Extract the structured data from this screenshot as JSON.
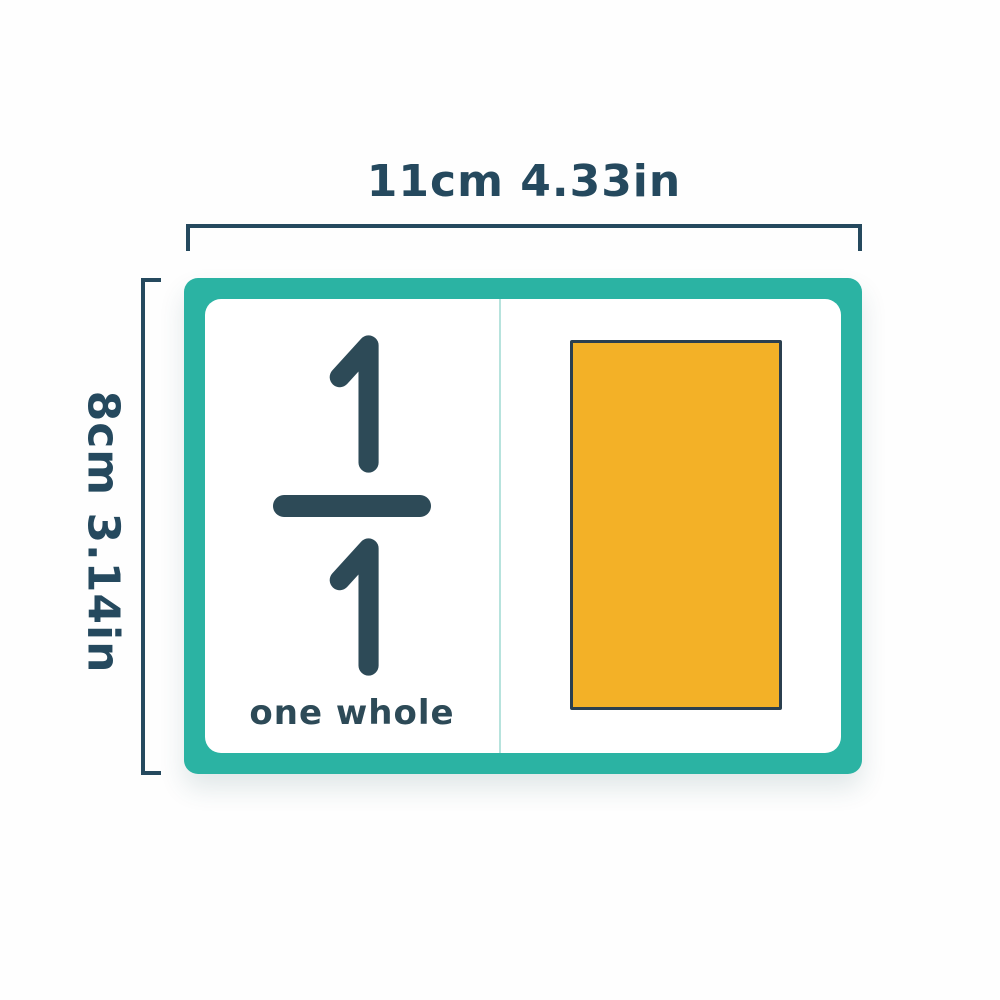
{
  "figure": {
    "description_label": "fraction flashcard dimension diagram"
  },
  "dimensions": {
    "width_label": "11cm 4.33in",
    "height_label": "8cm 3.14in"
  },
  "card": {
    "fraction": {
      "numerator": "1",
      "denominator": "1",
      "label": "one whole"
    },
    "shape": "whole-rectangle"
  },
  "colors": {
    "page_bg": "#fefefe",
    "text_dark": "#25495e",
    "line_dark": "#25495e",
    "digit_dark": "#2d4a57",
    "card_border_teal": "#2bb3a3",
    "divider_teal": "#b7e3dd",
    "shape_fill": "#f3b127",
    "shape_outline": "#2b3f4f"
  }
}
